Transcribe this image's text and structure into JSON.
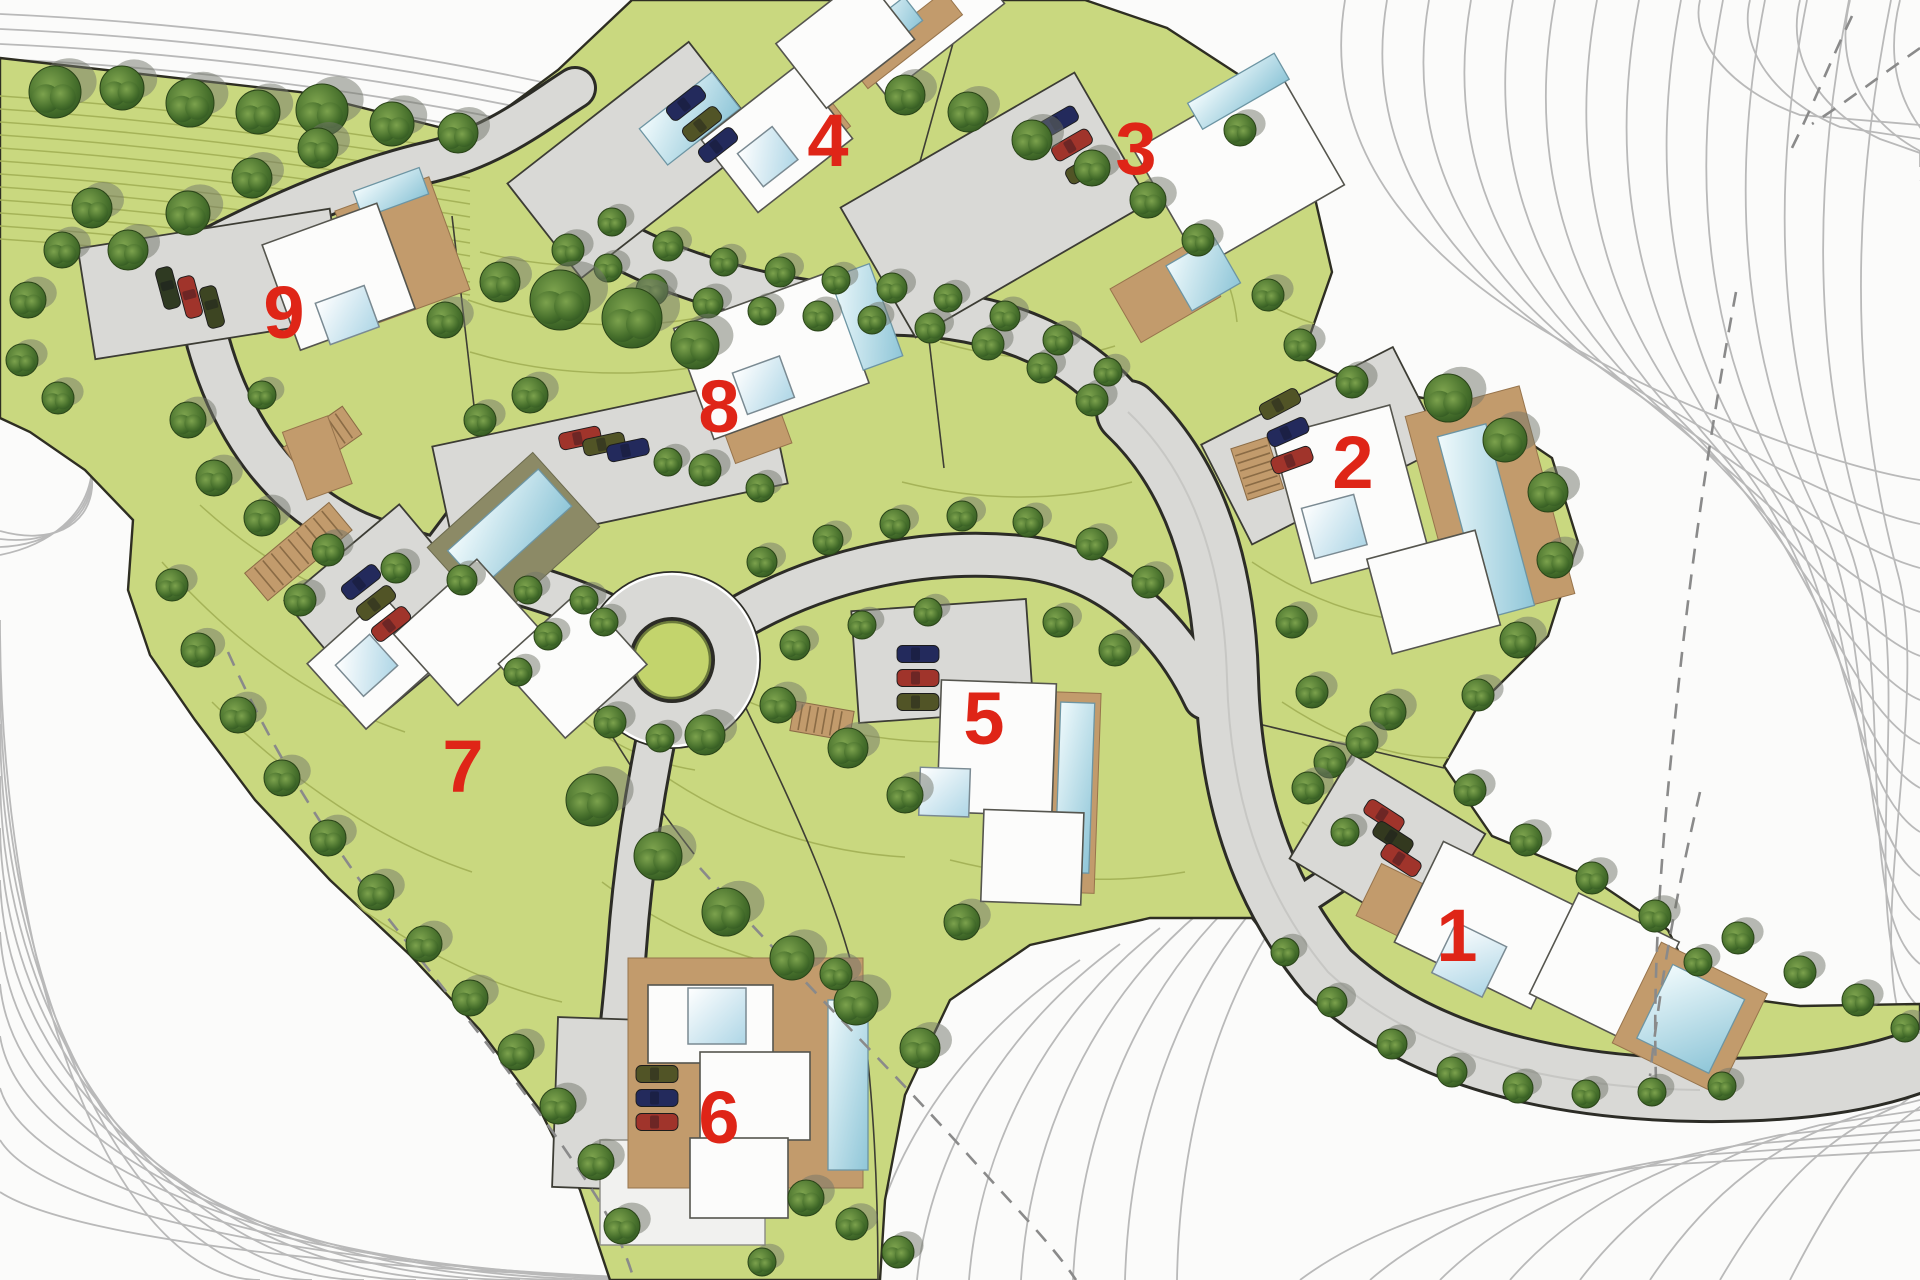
{
  "map": {
    "type": "residential-site-plan",
    "plot_count": 9,
    "label_color": "#df2517",
    "colors": {
      "site_green": "#c9d87f",
      "contour_on_green": "#a3b156",
      "contour_on_white": "#b9b9b9",
      "road_gray": "#d9d9d6",
      "road_edge": "#2c2c26",
      "tree_green": "#3f6526",
      "tree_shadow": "#71756a",
      "house_white": "#fcfcfb",
      "deck_tan": "#c29b6c",
      "pool_blue": "#9fcede",
      "car_navy": "#232a5c",
      "car_red": "#a0342b",
      "car_olive": "#515426"
    },
    "plots": [
      {
        "number": "1",
        "label_x": 1457,
        "label_y": 935,
        "has_pool": true,
        "cars": [
          {
            "x": 1384,
            "y": 816,
            "angle": 33,
            "color": "#a0342b"
          },
          {
            "x": 1393,
            "y": 838,
            "angle": 33,
            "color": "#33391f"
          },
          {
            "x": 1401,
            "y": 860,
            "angle": 33,
            "color": "#a0342b"
          }
        ]
      },
      {
        "number": "2",
        "label_x": 1353,
        "label_y": 462,
        "has_pool": true,
        "cars": [
          {
            "x": 1280,
            "y": 404,
            "angle": -28,
            "color": "#515426"
          },
          {
            "x": 1288,
            "y": 432,
            "angle": -24,
            "color": "#232a5c"
          },
          {
            "x": 1292,
            "y": 460,
            "angle": -20,
            "color": "#a0342b"
          }
        ]
      },
      {
        "number": "3",
        "label_x": 1136,
        "label_y": 148,
        "has_pool": true,
        "cars": [
          {
            "x": 1058,
            "y": 122,
            "angle": -30,
            "color": "#232a5c"
          },
          {
            "x": 1072,
            "y": 145,
            "angle": -30,
            "color": "#a0342b"
          },
          {
            "x": 1086,
            "y": 168,
            "angle": -30,
            "color": "#515426"
          }
        ]
      },
      {
        "number": "4",
        "label_x": 828,
        "label_y": 140,
        "has_pool": true,
        "cars": [
          {
            "x": 686,
            "y": 103,
            "angle": -38,
            "color": "#232a5c"
          },
          {
            "x": 702,
            "y": 124,
            "angle": -38,
            "color": "#515426"
          },
          {
            "x": 718,
            "y": 145,
            "angle": -38,
            "color": "#232a5c"
          }
        ]
      },
      {
        "number": "5",
        "label_x": 984,
        "label_y": 718,
        "has_pool": true,
        "cars": [
          {
            "x": 918,
            "y": 654,
            "angle": 0,
            "color": "#232a5c"
          },
          {
            "x": 918,
            "y": 678,
            "angle": 0,
            "color": "#a0342b"
          },
          {
            "x": 918,
            "y": 702,
            "angle": 0,
            "color": "#515426"
          }
        ]
      },
      {
        "number": "6",
        "label_x": 719,
        "label_y": 1117,
        "has_pool": true,
        "cars": [
          {
            "x": 657,
            "y": 1074,
            "angle": 0,
            "color": "#515426"
          },
          {
            "x": 657,
            "y": 1098,
            "angle": 0,
            "color": "#232a5c"
          },
          {
            "x": 657,
            "y": 1122,
            "angle": 0,
            "color": "#a0342b"
          }
        ]
      },
      {
        "number": "7",
        "label_x": 463,
        "label_y": 766,
        "has_pool": true,
        "cars": [
          {
            "x": 361,
            "y": 582,
            "angle": -38,
            "color": "#232a5c"
          },
          {
            "x": 376,
            "y": 603,
            "angle": -38,
            "color": "#515426"
          },
          {
            "x": 391,
            "y": 624,
            "angle": -38,
            "color": "#a0342b"
          }
        ]
      },
      {
        "number": "8",
        "label_x": 719,
        "label_y": 406,
        "has_pool": true,
        "cars": [
          {
            "x": 580,
            "y": 438,
            "angle": -12,
            "color": "#a0342b"
          },
          {
            "x": 604,
            "y": 444,
            "angle": -12,
            "color": "#515426"
          },
          {
            "x": 628,
            "y": 450,
            "angle": -12,
            "color": "#232a5c"
          }
        ]
      },
      {
        "number": "9",
        "label_x": 284,
        "label_y": 312,
        "has_pool": true,
        "cars": [
          {
            "x": 168,
            "y": 288,
            "angle": 75,
            "color": "#2f3a22"
          },
          {
            "x": 190,
            "y": 297,
            "angle": 75,
            "color": "#a0342b"
          },
          {
            "x": 212,
            "y": 307,
            "angle": 75,
            "color": "#3d4522"
          }
        ]
      }
    ],
    "trees": [
      [
        55,
        92,
        26
      ],
      [
        122,
        88,
        22
      ],
      [
        190,
        103,
        24
      ],
      [
        258,
        112,
        22
      ],
      [
        322,
        110,
        26
      ],
      [
        392,
        124,
        22
      ],
      [
        458,
        133,
        20
      ],
      [
        128,
        250,
        20
      ],
      [
        188,
        213,
        22
      ],
      [
        252,
        178,
        20
      ],
      [
        318,
        148,
        20
      ],
      [
        92,
        208,
        20
      ],
      [
        62,
        250,
        18
      ],
      [
        28,
        300,
        18
      ],
      [
        22,
        360,
        16
      ],
      [
        58,
        398,
        16
      ],
      [
        568,
        250,
        16
      ],
      [
        608,
        268,
        14
      ],
      [
        652,
        290,
        16
      ],
      [
        708,
        303,
        15
      ],
      [
        762,
        311,
        14
      ],
      [
        818,
        316,
        15
      ],
      [
        872,
        320,
        14
      ],
      [
        930,
        328,
        15
      ],
      [
        988,
        344,
        16
      ],
      [
        1042,
        368,
        15
      ],
      [
        1092,
        400,
        16
      ],
      [
        612,
        222,
        14
      ],
      [
        668,
        246,
        15
      ],
      [
        724,
        262,
        14
      ],
      [
        780,
        272,
        15
      ],
      [
        836,
        280,
        14
      ],
      [
        892,
        288,
        15
      ],
      [
        948,
        298,
        14
      ],
      [
        1005,
        316,
        15
      ],
      [
        1058,
        340,
        15
      ],
      [
        1108,
        372,
        14
      ],
      [
        905,
        95,
        20
      ],
      [
        968,
        112,
        20
      ],
      [
        1032,
        140,
        20
      ],
      [
        1092,
        168,
        18
      ],
      [
        1148,
        200,
        18
      ],
      [
        1198,
        240,
        16
      ],
      [
        1240,
        130,
        16
      ],
      [
        1268,
        295,
        16
      ],
      [
        560,
        300,
        30
      ],
      [
        632,
        318,
        30
      ],
      [
        695,
        345,
        24
      ],
      [
        500,
        282,
        20
      ],
      [
        445,
        320,
        18
      ],
      [
        530,
        395,
        18
      ],
      [
        480,
        420,
        16
      ],
      [
        262,
        395,
        14
      ],
      [
        668,
        462,
        14
      ],
      [
        705,
        470,
        16
      ],
      [
        760,
        488,
        14
      ],
      [
        188,
        420,
        18
      ],
      [
        214,
        478,
        18
      ],
      [
        262,
        518,
        18
      ],
      [
        328,
        550,
        16
      ],
      [
        396,
        568,
        15
      ],
      [
        462,
        580,
        15
      ],
      [
        528,
        590,
        14
      ],
      [
        584,
        600,
        14
      ],
      [
        300,
        600,
        16
      ],
      [
        604,
        622,
        14
      ],
      [
        548,
        636,
        14
      ],
      [
        518,
        672,
        14
      ],
      [
        610,
        722,
        16
      ],
      [
        660,
        738,
        14
      ],
      [
        762,
        562,
        15
      ],
      [
        828,
        540,
        15
      ],
      [
        895,
        524,
        15
      ],
      [
        962,
        516,
        15
      ],
      [
        1028,
        522,
        15
      ],
      [
        1092,
        544,
        16
      ],
      [
        1148,
        582,
        16
      ],
      [
        795,
        645,
        15
      ],
      [
        862,
        625,
        14
      ],
      [
        928,
        612,
        14
      ],
      [
        1058,
        622,
        15
      ],
      [
        1115,
        650,
        16
      ],
      [
        705,
        735,
        20
      ],
      [
        778,
        705,
        18
      ],
      [
        848,
        748,
        20
      ],
      [
        905,
        795,
        18
      ],
      [
        592,
        800,
        26
      ],
      [
        658,
        856,
        24
      ],
      [
        726,
        912,
        24
      ],
      [
        792,
        958,
        22
      ],
      [
        856,
        1003,
        22
      ],
      [
        920,
        1048,
        20
      ],
      [
        962,
        922,
        18
      ],
      [
        172,
        585,
        16
      ],
      [
        198,
        650,
        17
      ],
      [
        238,
        715,
        18
      ],
      [
        282,
        778,
        18
      ],
      [
        328,
        838,
        18
      ],
      [
        376,
        892,
        18
      ],
      [
        424,
        944,
        18
      ],
      [
        470,
        998,
        18
      ],
      [
        516,
        1052,
        18
      ],
      [
        558,
        1106,
        18
      ],
      [
        596,
        1162,
        18
      ],
      [
        622,
        1226,
        18
      ],
      [
        836,
        974,
        16
      ],
      [
        806,
        1198,
        18
      ],
      [
        852,
        1224,
        16
      ],
      [
        898,
        1252,
        16
      ],
      [
        762,
        1262,
        14
      ],
      [
        1448,
        398,
        24
      ],
      [
        1505,
        440,
        22
      ],
      [
        1548,
        492,
        20
      ],
      [
        1555,
        560,
        18
      ],
      [
        1518,
        640,
        18
      ],
      [
        1478,
        695,
        16
      ],
      [
        1352,
        382,
        16
      ],
      [
        1300,
        345,
        16
      ],
      [
        1292,
        622,
        16
      ],
      [
        1312,
        692,
        16
      ],
      [
        1330,
        762,
        16
      ],
      [
        1345,
        832,
        14
      ],
      [
        1388,
        712,
        18
      ],
      [
        1308,
        788,
        16
      ],
      [
        1362,
        742,
        16
      ],
      [
        1470,
        790,
        16
      ],
      [
        1526,
        840,
        16
      ],
      [
        1592,
        878,
        16
      ],
      [
        1655,
        916,
        16
      ],
      [
        1698,
        962,
        14
      ],
      [
        1738,
        938,
        16
      ],
      [
        1800,
        972,
        16
      ],
      [
        1858,
        1000,
        16
      ],
      [
        1905,
        1028,
        14
      ],
      [
        1285,
        952,
        14
      ],
      [
        1332,
        1002,
        15
      ],
      [
        1392,
        1044,
        15
      ],
      [
        1452,
        1072,
        15
      ],
      [
        1518,
        1088,
        15
      ],
      [
        1586,
        1094,
        14
      ],
      [
        1652,
        1092,
        14
      ],
      [
        1722,
        1086,
        14
      ]
    ]
  }
}
